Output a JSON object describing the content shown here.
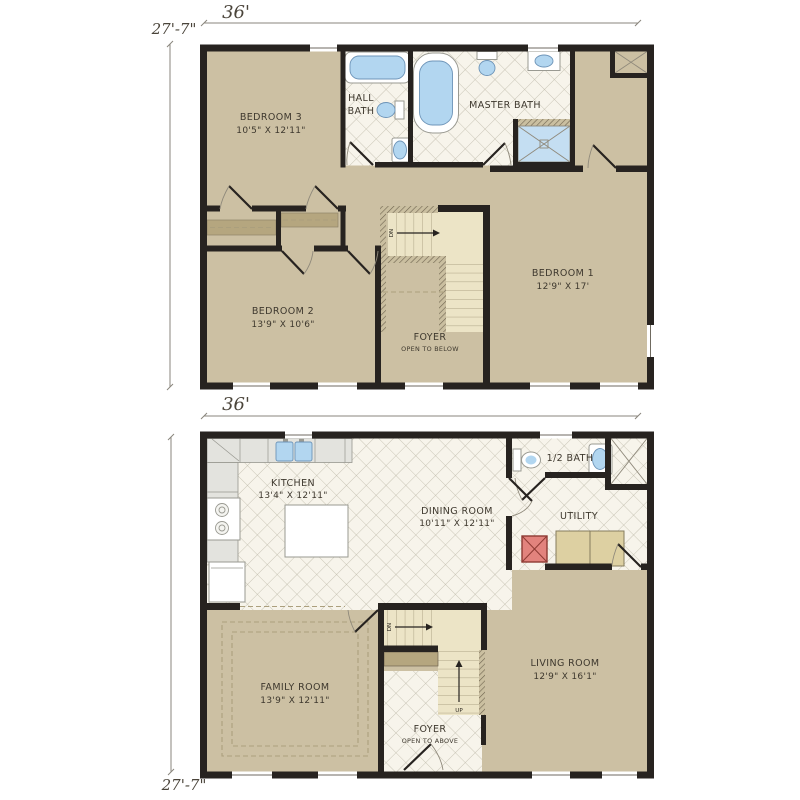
{
  "colors": {
    "wall": "#272320",
    "carpet_tan": "#ccc0a3",
    "tile_background": "#f7f4eb",
    "tile_line": "#bdb8a8",
    "stair_cream": "#ece4c6",
    "railing_hatch": "#6f6450",
    "fixture_water_blue": "#b2d6f0",
    "water_heater_red": "#e2837d",
    "appliance_tan": "#ddd0a2",
    "dimension_text": "#4a443a",
    "label_text": "#3e382e"
  },
  "upper_floor": {
    "width_dim": "36'",
    "height_dim": "27'-7\"",
    "rooms": {
      "bedroom3": {
        "name": "BEDROOM 3",
        "size": "10'5\" X 12'11\""
      },
      "hall_bath": {
        "name_line1": "HALL",
        "name_line2": "BATH"
      },
      "master_bath": {
        "name": "MASTER BATH"
      },
      "bedroom1": {
        "name": "BEDROOM 1",
        "size": "12'9\" X 17'"
      },
      "bedroom2": {
        "name": "BEDROOM 2",
        "size": "13'9\" X 10'6\""
      },
      "foyer": {
        "name": "FOYER",
        "note": "OPEN TO BELOW"
      }
    },
    "stairs": {
      "down": "DN"
    }
  },
  "lower_floor": {
    "width_dim": "36'",
    "height_dim": "27'-7\"",
    "rooms": {
      "kitchen": {
        "name": "KITCHEN",
        "size": "13'4\" X 12'11\""
      },
      "dining": {
        "name": "DINING ROOM",
        "size": "10'11\" X 12'11\""
      },
      "half_bath": {
        "name": "1/2 BATH"
      },
      "utility": {
        "name": "UTILITY"
      },
      "family": {
        "name": "FAMILY ROOM",
        "size": "13'9\" X 12'11\""
      },
      "living": {
        "name": "LIVING ROOM",
        "size": "12'9\" X 16'1\""
      },
      "foyer": {
        "name": "FOYER",
        "note": "OPEN TO ABOVE"
      }
    },
    "stairs": {
      "down": "DN",
      "up": "UP"
    }
  }
}
